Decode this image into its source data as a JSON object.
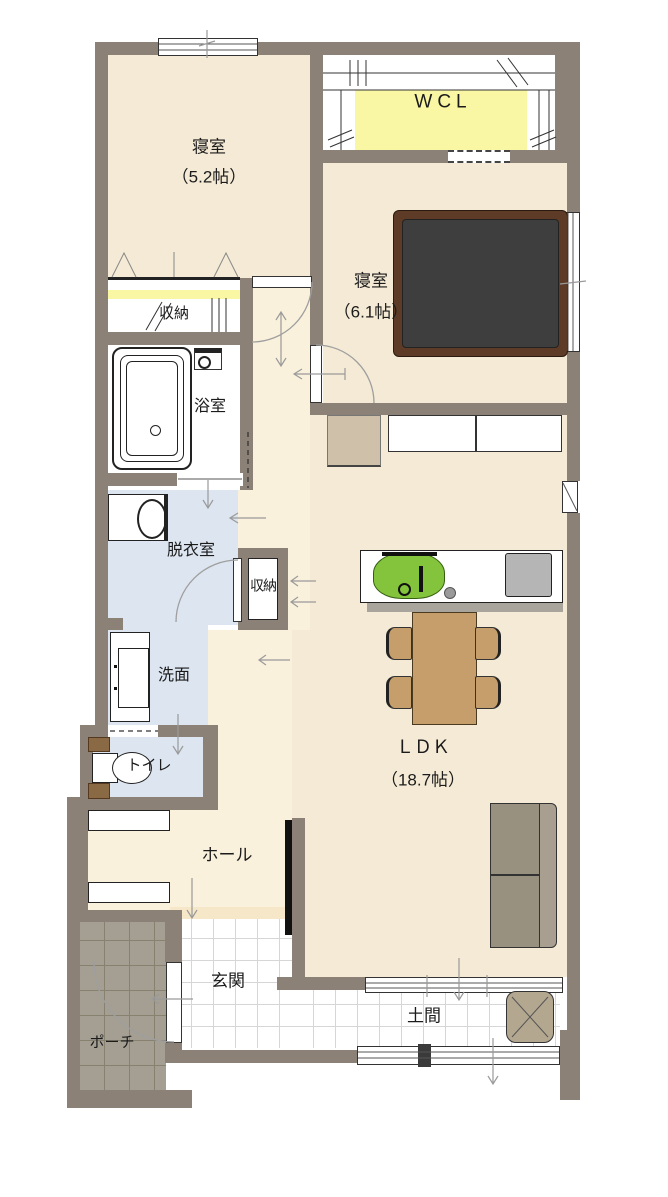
{
  "rooms": {
    "bedroom1": {
      "label": "寝室",
      "size": "（5.2帖）"
    },
    "wcl": {
      "label": "WCL"
    },
    "bedroom2": {
      "label": "寝室",
      "size": "（6.1帖）"
    },
    "closet1": {
      "label": "収納"
    },
    "bathroom": {
      "label": "浴室"
    },
    "dressing_room": {
      "label": "脱衣室"
    },
    "closet2": {
      "label": "収納"
    },
    "washroom": {
      "label": "洗面"
    },
    "toilet": {
      "label": "トイレ"
    },
    "hall": {
      "label": "ホール"
    },
    "entrance": {
      "label": "玄関"
    },
    "porch": {
      "label": "ポーチ"
    },
    "ldk": {
      "label": "ＬＤＫ",
      "size": "（18.7帖）"
    },
    "doma": {
      "label": "土間"
    }
  },
  "colors": {
    "wall": "#8b8176",
    "floor_cream": "#f4ead5",
    "floor_hall": "#f9f1dc",
    "floor_blue": "#dde5f0",
    "closet_yellow": "#f9f7a3",
    "porch_tile": "#a49e93",
    "bed_frame": "#5d3b27",
    "bed_mattress": "#3e3e3e",
    "wood": "#c59e6b",
    "sofa": "#99917f",
    "sofa_back": "#a89f90",
    "sink_green": "#84c43c",
    "stove_gray": "#b5b5b5",
    "desk": "#cfc0a9",
    "armchair": "#b3a78f",
    "tv_black": "#111111",
    "shelf_brown": "#8a6a44",
    "step": "#f6e7c9"
  }
}
